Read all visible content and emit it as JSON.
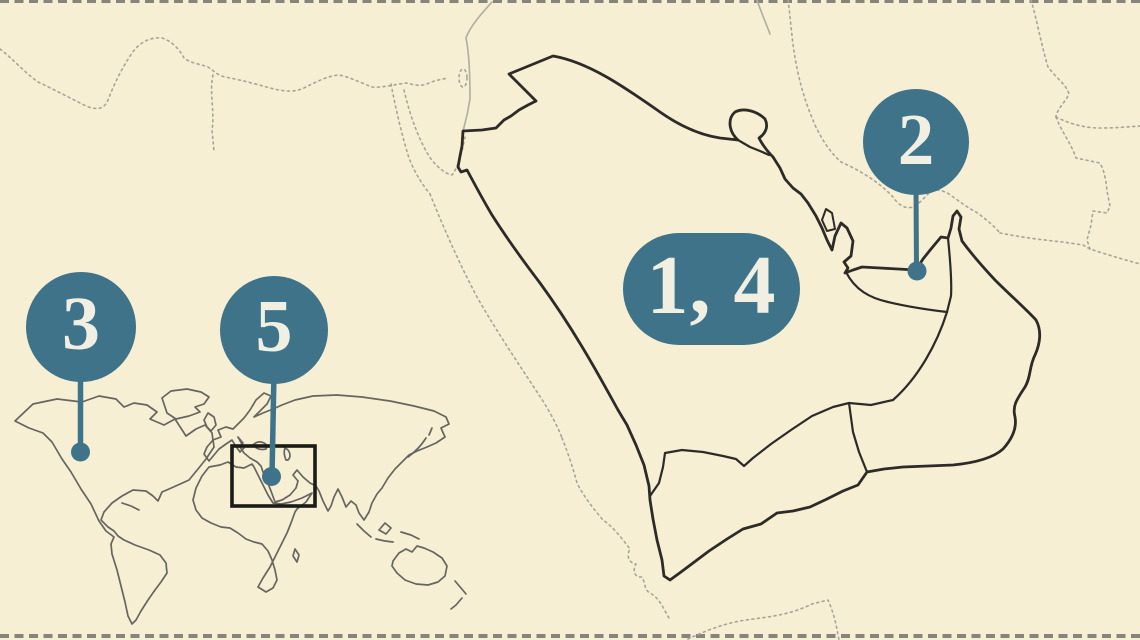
{
  "markers": {
    "region_1_4": {
      "label": "1, 4"
    },
    "region_2": {
      "label": "2"
    },
    "region_3": {
      "label": "3"
    },
    "region_5": {
      "label": "5"
    }
  },
  "colors": {
    "background": "#f6efd4",
    "marker_fill": "#3e7389",
    "marker_text": "#f0efe2",
    "country_outline": "#2d2b27",
    "neighbor_lines": "#a6a597",
    "neighbor_solid": "#b2b1a1",
    "world_outline": "#66655f",
    "highlight_box": "#1b1b18",
    "frame_dashes": "#85857a"
  }
}
